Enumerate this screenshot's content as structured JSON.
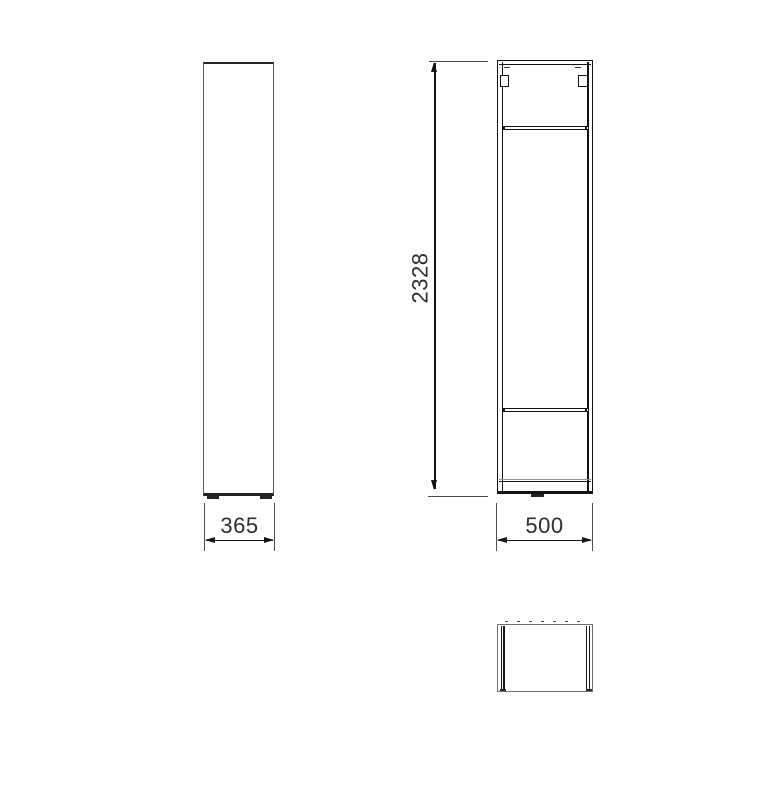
{
  "drawing": {
    "type": "technical-drawing",
    "subject": "tall-cabinet",
    "background_color": "#ffffff",
    "line_color": "#161616",
    "secondary_line_color": "#6a6a6a",
    "extension_line_color": "#4d4d4d",
    "text_color": "#2d2d2d",
    "views": [
      {
        "id": "front-view",
        "position": "left"
      },
      {
        "id": "side-view",
        "position": "right"
      },
      {
        "id": "top-view",
        "position": "bottom-right"
      }
    ],
    "dimensions": {
      "width": {
        "value": "365",
        "orientation": "horizontal",
        "view": "front-view"
      },
      "height": {
        "value": "2328",
        "orientation": "vertical",
        "view": "side-view"
      },
      "depth": {
        "value": "500",
        "orientation": "horizontal",
        "view": "side-view"
      }
    }
  }
}
